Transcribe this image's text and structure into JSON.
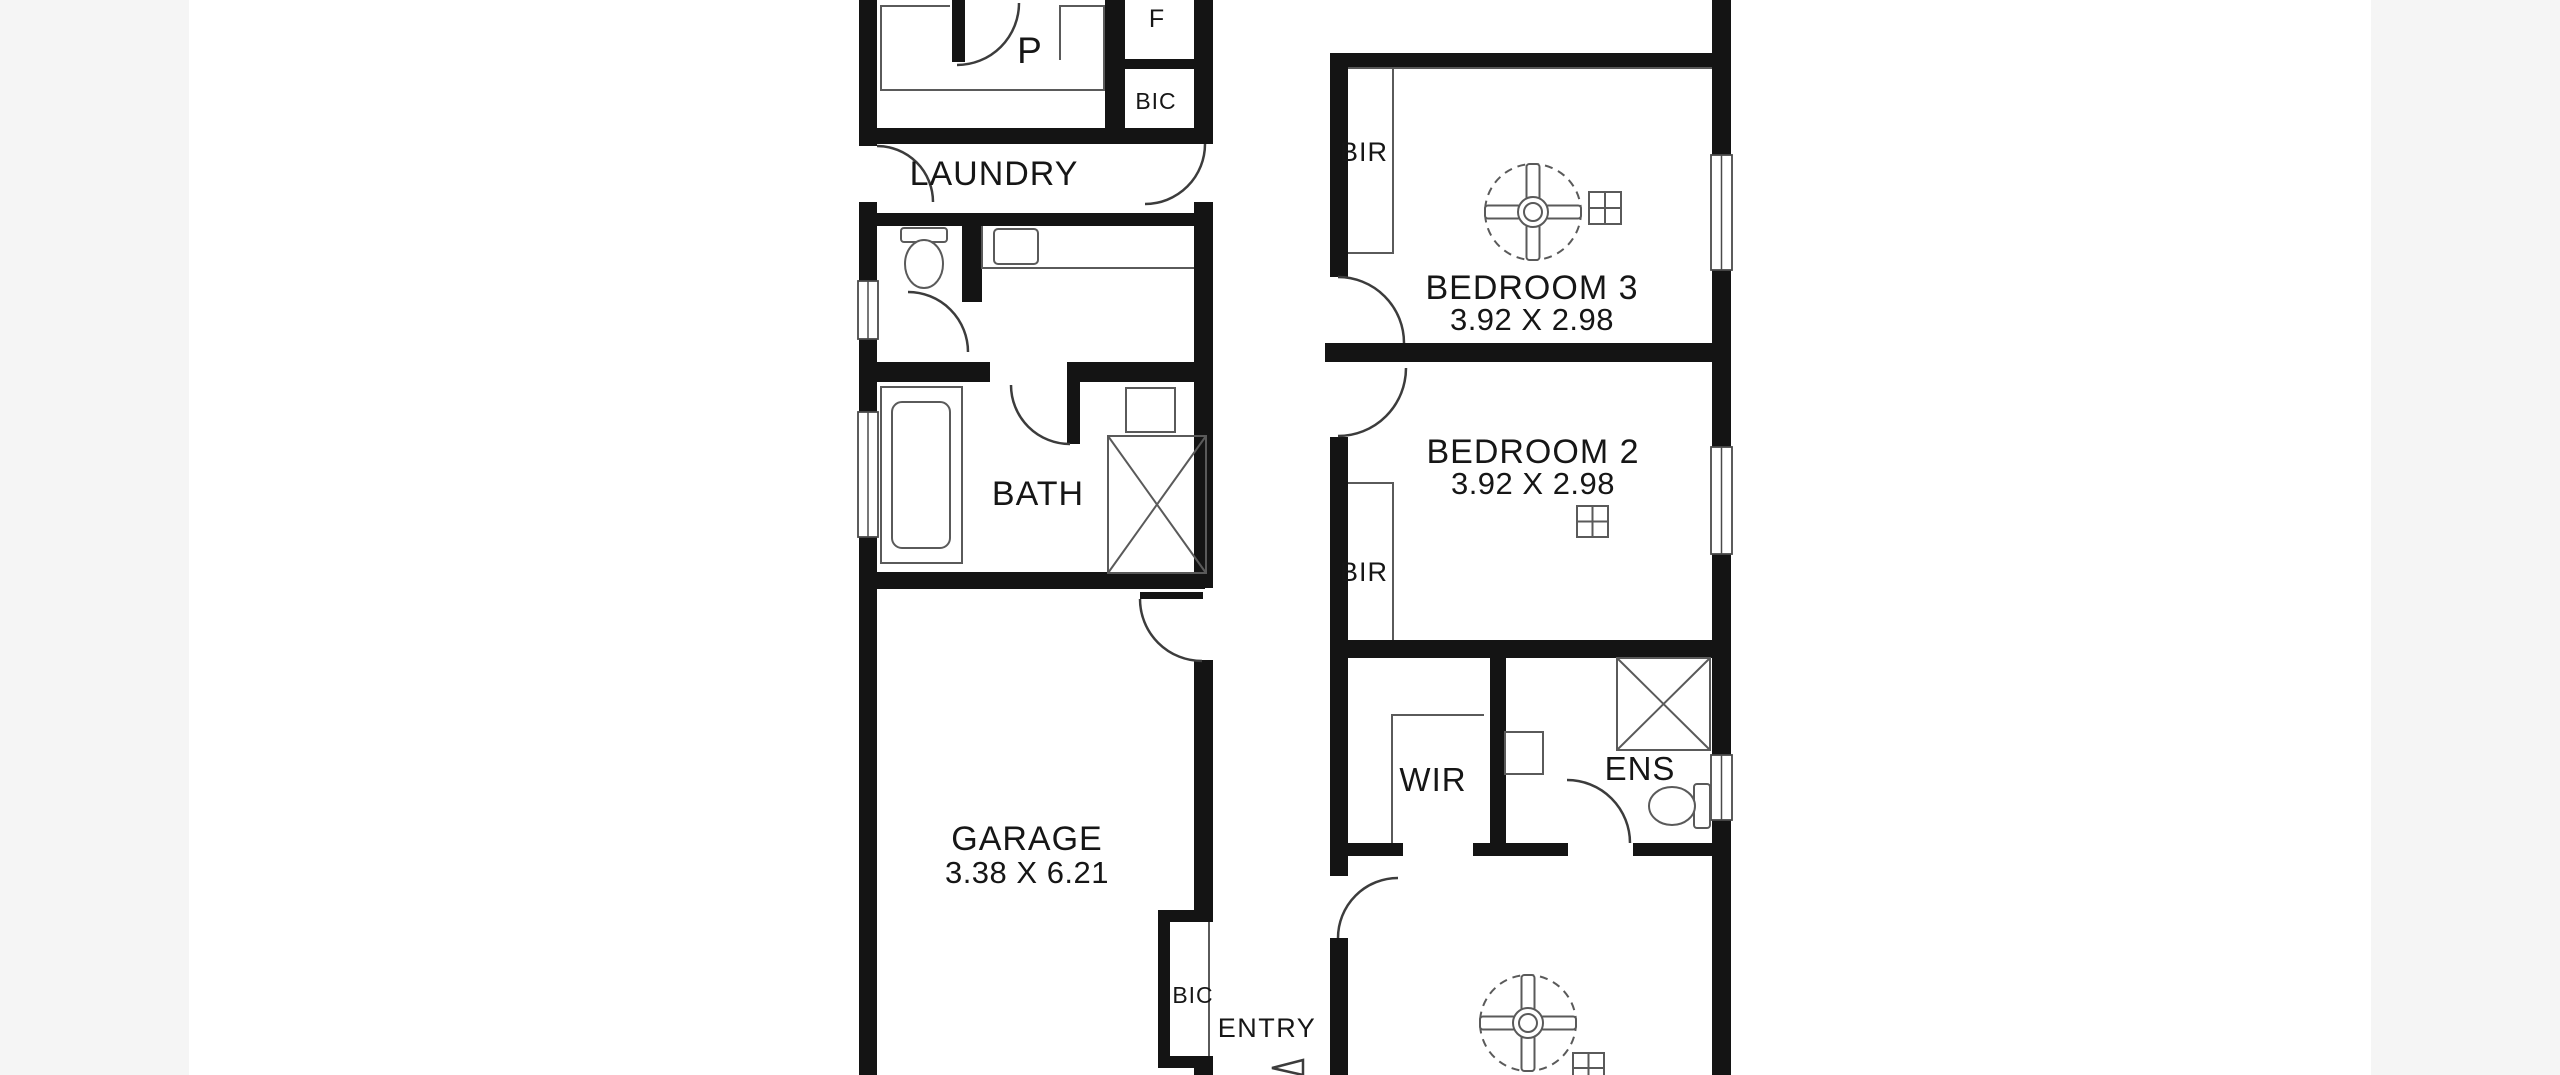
{
  "image_type": "residential floor plan drawing",
  "colors": {
    "wall": "#141414",
    "fixture_line": "#5a5a5a",
    "door_arc": "#3c3c3c",
    "text": "#161616",
    "plan_background": "#ffffff",
    "page_edge_background": "#f5f5f5"
  },
  "rooms": {
    "pantry": {
      "label": "P"
    },
    "fridge_recess": {
      "label": "F"
    },
    "laundry_cupboard": {
      "label": "BIC"
    },
    "laundry": {
      "label": "LAUNDRY"
    },
    "bath": {
      "label": "BATH"
    },
    "garage": {
      "label": "GARAGE",
      "dims": "3.38 X 6.21"
    },
    "bedroom3": {
      "label": "BEDROOM 3",
      "dims": "3.92 X 2.98",
      "robe": "BIR"
    },
    "bedroom2": {
      "label": "BEDROOM 2",
      "dims": "3.92 X 2.98",
      "robe": "BIR"
    },
    "wir": {
      "label": "WIR"
    },
    "ens": {
      "label": "ENS"
    },
    "entry": {
      "label": "ENTRY",
      "cupboard": "BIC"
    }
  },
  "symbols": [
    "ceiling-fan",
    "toilet",
    "bathtub",
    "shower",
    "vanity-basin",
    "laundry-trough",
    "kitchen-counter",
    "window",
    "door-swing",
    "vent-square"
  ]
}
